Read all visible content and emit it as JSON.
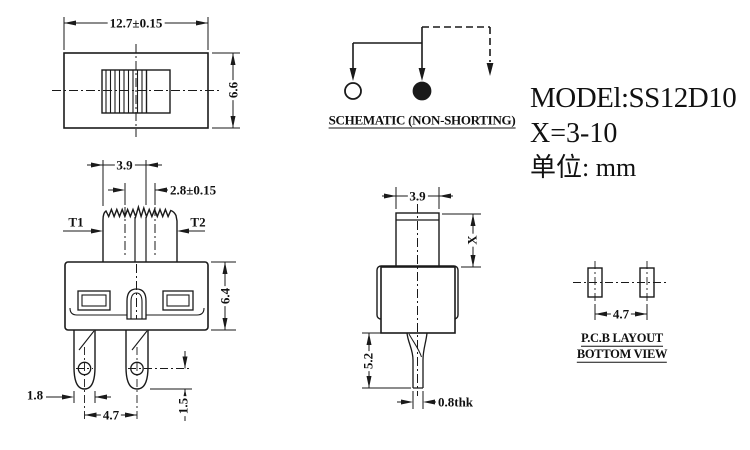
{
  "drawing": {
    "title_block": {
      "model": "MODEl:SS12D10",
      "travel_range": "X=3-10",
      "unit": "单位: mm"
    },
    "schematic": {
      "caption": "SCHEMATIC (NON-SHORTING)"
    },
    "top_view": {
      "width": "12.7±0.15",
      "height": "6.6"
    },
    "front_view": {
      "knob_width": "3.9",
      "travel": "2.8±0.15",
      "terminal_left": "T1",
      "terminal_right": "T2",
      "body_height": "6.4",
      "leg_width": "1.8",
      "pin_pitch": "4.7",
      "hole_offset": "1.5"
    },
    "side_view": {
      "knob_width": "3.9",
      "knob_height": "X",
      "leg_length": "5.2",
      "thickness": "0.8thk"
    },
    "pcb_view": {
      "pitch": "4.7",
      "caption_line1": "P.C.B LAYOUT",
      "caption_line2": "BOTTOM VIEW"
    },
    "colors": {
      "line": "#1a1a1a",
      "background": "#ffffff"
    }
  }
}
